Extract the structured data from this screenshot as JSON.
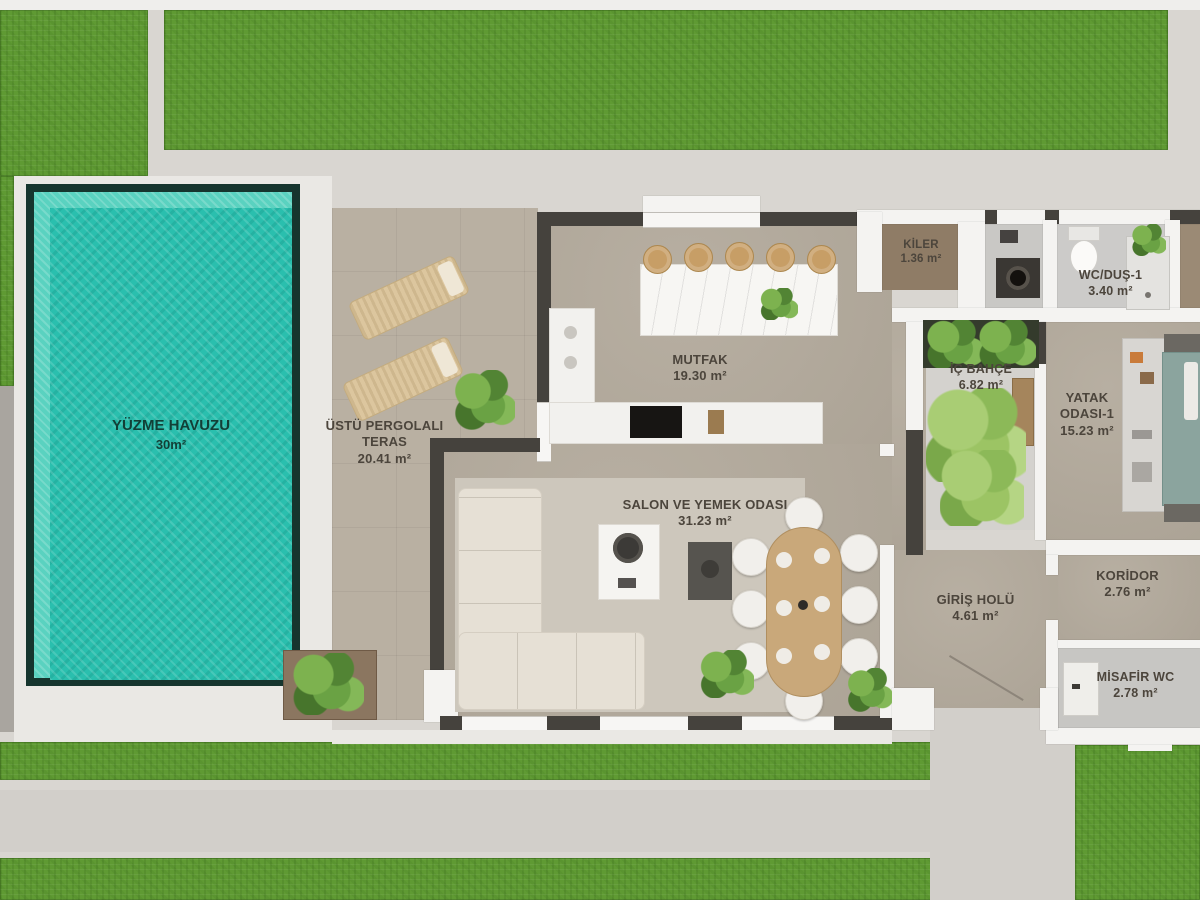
{
  "plan": {
    "pool": {
      "label": "YÜZME HAVUZU",
      "area": "30m²"
    },
    "rooms": [
      {
        "id": "ustu-pergolali-teras",
        "label": "ÜSTÜ PERGOLALI TERAS",
        "area": "20.41 m²"
      },
      {
        "id": "mutfak",
        "label": "MUTFAK",
        "area": "19.30 m²"
      },
      {
        "id": "salon-ve-yemek-odasi",
        "label": "SALON VE YEMEK ODASI",
        "area": "31.23 m²"
      },
      {
        "id": "kiler",
        "label": "KİLER",
        "area": "1.36 m²"
      },
      {
        "id": "wc-dus-1",
        "label": "WC/DUŞ-1",
        "area": "3.40 m²"
      },
      {
        "id": "ic-bahce",
        "label": "İÇ BAHÇE",
        "area": "6.82 m²"
      },
      {
        "id": "yatak-odasi-1",
        "label": "YATAK ODASI-1",
        "area": "15.23 m²"
      },
      {
        "id": "giris-holu",
        "label": "GİRİŞ HOLÜ",
        "area": "4.61 m²"
      },
      {
        "id": "koridor",
        "label": "KORİDOR",
        "area": "2.76 m²"
      },
      {
        "id": "misafir-wc",
        "label": "MİSAFİR WC",
        "area": "2.78 m²"
      }
    ],
    "colors": {
      "grass": "#5f9a33",
      "pool_water": "#2abfae",
      "pool_ledge": "#5ad2c0",
      "pool_frame": "#16352e",
      "terrace_floor": "#b9b0a2",
      "interior_floor": "#b3aa9c",
      "wall_dark": "#45423d",
      "wall_light": "#f4f3f1",
      "walkway": "#d9d6d1",
      "deck": "#eae8e4",
      "label_text": "#4c453c"
    }
  }
}
